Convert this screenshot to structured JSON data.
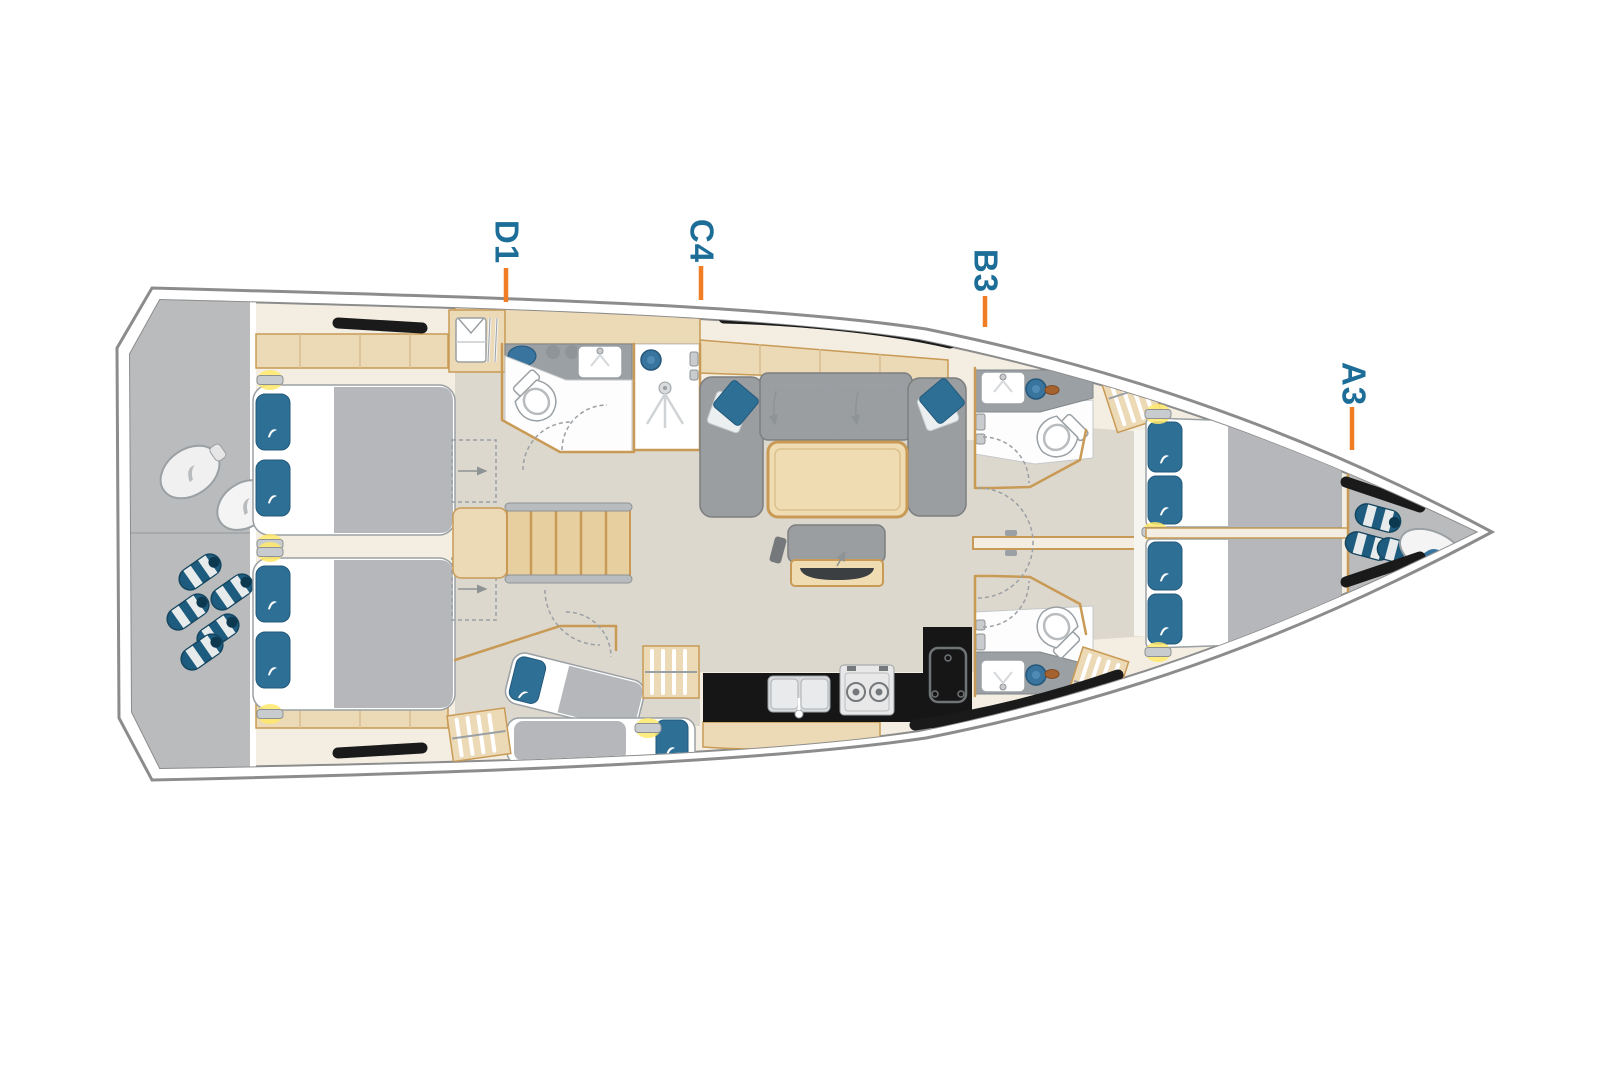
{
  "diagram": {
    "type": "yacht-interior-floor-plan",
    "orientation": "bow-right",
    "cabin_labels": [
      {
        "label": "D1"
      },
      {
        "label": "C4"
      },
      {
        "label": "B3"
      },
      {
        "label": "A3"
      }
    ],
    "colors": {
      "label_text": "#1c6d97",
      "tick_orange": "#f07c24",
      "hull_outline": "#8c8c8c",
      "deck_cream": "#f3eee1",
      "wood_light": "#ecd9b6",
      "wood_outline": "#c89a55",
      "floor_grey_beige": "#ddd8cd",
      "stern_garage_grey": "#b9bbbd",
      "sofa_grey": "#9b9ea1",
      "mattress_grey": "#b5b7ba",
      "pillow_blue": "#2e6f96",
      "counter_grey": "#9aa0a4",
      "galley_counter_black": "#161616",
      "window_black": "#1a1a1a",
      "reading_light_yellow": "#ffe96b"
    },
    "furniture_icons": [
      "double-bed",
      "single-berth",
      "pillow",
      "reading-light",
      "wardrobe",
      "hanging-shirt",
      "toilet",
      "washbasin",
      "shower",
      "sofa",
      "saloon-table",
      "chart-table-bench",
      "galley-sink",
      "stove",
      "fridge",
      "companionway-stairs",
      "fender-roll",
      "fender-bag",
      "hull-window",
      "deck-hatch",
      "door-swing-arc",
      "berth-extension-arrow"
    ]
  }
}
